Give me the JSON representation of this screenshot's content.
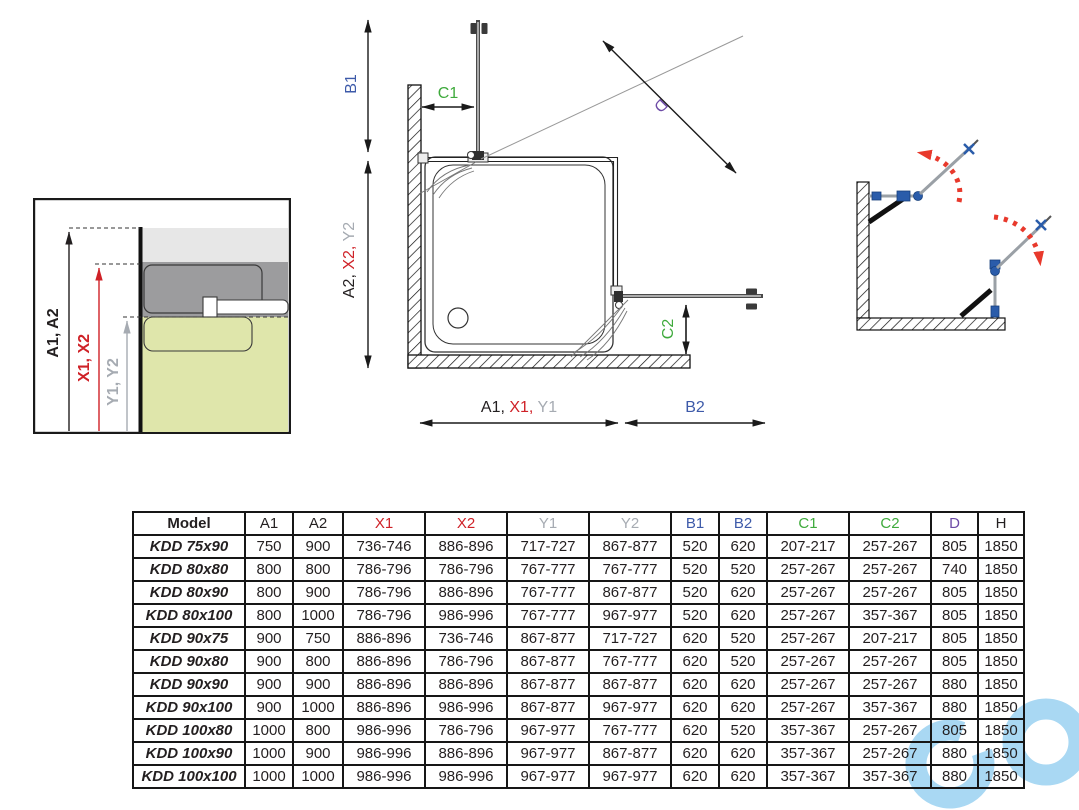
{
  "palette": {
    "black": "#231f20",
    "red": "#cf2127",
    "gray": "#a6abb2",
    "blue": "#3d5aa9",
    "green": "#3faa3c",
    "purple": "#6d4ba6",
    "hardware_blue": "#2a5caa",
    "swing_red": "#e8392c",
    "wall_light_gray": "#e7e7e7",
    "profile_gray": "#9c9c9e",
    "glass_green": "#dfe6ab",
    "watermark_blue": "#a9d8f3"
  },
  "detail_view": {
    "a_label": "A1, A2",
    "x_label": "X1, X2",
    "y_label": "Y1, Y2"
  },
  "plan_view": {
    "b1_label": "B1",
    "c1_label": "C1",
    "d_label": "D",
    "c2_label": "C2",
    "b2_label": "B2",
    "vertical_axis_parts": [
      {
        "text": "A2, ",
        "color": "black"
      },
      {
        "text": "X2, ",
        "color": "red"
      },
      {
        "text": "Y2",
        "color": "gray"
      }
    ],
    "horizontal_axis_parts": [
      {
        "text": "A1, ",
        "color": "black"
      },
      {
        "text": "X1, ",
        "color": "red"
      },
      {
        "text": "Y1",
        "color": "gray"
      }
    ]
  },
  "spec_table": {
    "headers": [
      {
        "label": "Model",
        "color": "black"
      },
      {
        "label": "A1",
        "color": "black"
      },
      {
        "label": "A2",
        "color": "black"
      },
      {
        "label": "X1",
        "color": "red"
      },
      {
        "label": "X2",
        "color": "red"
      },
      {
        "label": "Y1",
        "color": "gray"
      },
      {
        "label": "Y2",
        "color": "gray"
      },
      {
        "label": "B1",
        "color": "blue"
      },
      {
        "label": "B2",
        "color": "blue"
      },
      {
        "label": "C1",
        "color": "green"
      },
      {
        "label": "C2",
        "color": "green"
      },
      {
        "label": "D",
        "color": "purple"
      },
      {
        "label": "H",
        "color": "black"
      }
    ],
    "rows": [
      {
        "model": "KDD 75x90",
        "values": [
          "750",
          "900",
          "736-746",
          "886-896",
          "717-727",
          "867-877",
          "520",
          "620",
          "207-217",
          "257-267",
          "805",
          "1850"
        ]
      },
      {
        "model": "KDD 80x80",
        "values": [
          "800",
          "800",
          "786-796",
          "786-796",
          "767-777",
          "767-777",
          "520",
          "520",
          "257-267",
          "257-267",
          "740",
          "1850"
        ]
      },
      {
        "model": "KDD 80x90",
        "values": [
          "800",
          "900",
          "786-796",
          "886-896",
          "767-777",
          "867-877",
          "520",
          "620",
          "257-267",
          "257-267",
          "805",
          "1850"
        ]
      },
      {
        "model": "KDD 80x100",
        "values": [
          "800",
          "1000",
          "786-796",
          "986-996",
          "767-777",
          "967-977",
          "520",
          "620",
          "257-267",
          "357-367",
          "805",
          "1850"
        ]
      },
      {
        "model": "KDD 90x75",
        "values": [
          "900",
          "750",
          "886-896",
          "736-746",
          "867-877",
          "717-727",
          "620",
          "520",
          "257-267",
          "207-217",
          "805",
          "1850"
        ]
      },
      {
        "model": "KDD 90x80",
        "values": [
          "900",
          "800",
          "886-896",
          "786-796",
          "867-877",
          "767-777",
          "620",
          "520",
          "257-267",
          "257-267",
          "805",
          "1850"
        ]
      },
      {
        "model": "KDD 90x90",
        "values": [
          "900",
          "900",
          "886-896",
          "886-896",
          "867-877",
          "867-877",
          "620",
          "620",
          "257-267",
          "257-267",
          "880",
          "1850"
        ]
      },
      {
        "model": "KDD 90x100",
        "values": [
          "900",
          "1000",
          "886-896",
          "986-996",
          "867-877",
          "967-977",
          "620",
          "620",
          "257-267",
          "357-367",
          "880",
          "1850"
        ]
      },
      {
        "model": "KDD 100x80",
        "values": [
          "1000",
          "800",
          "986-996",
          "786-796",
          "967-977",
          "767-777",
          "620",
          "520",
          "357-367",
          "257-267",
          "805",
          "1850"
        ]
      },
      {
        "model": "KDD 100x90",
        "values": [
          "1000",
          "900",
          "986-996",
          "886-896",
          "967-977",
          "867-877",
          "620",
          "620",
          "357-367",
          "257-267",
          "880",
          "1850"
        ]
      },
      {
        "model": "KDD 100x100",
        "values": [
          "1000",
          "1000",
          "986-996",
          "986-996",
          "967-977",
          "967-977",
          "620",
          "620",
          "357-367",
          "357-367",
          "880",
          "1850"
        ]
      }
    ]
  }
}
